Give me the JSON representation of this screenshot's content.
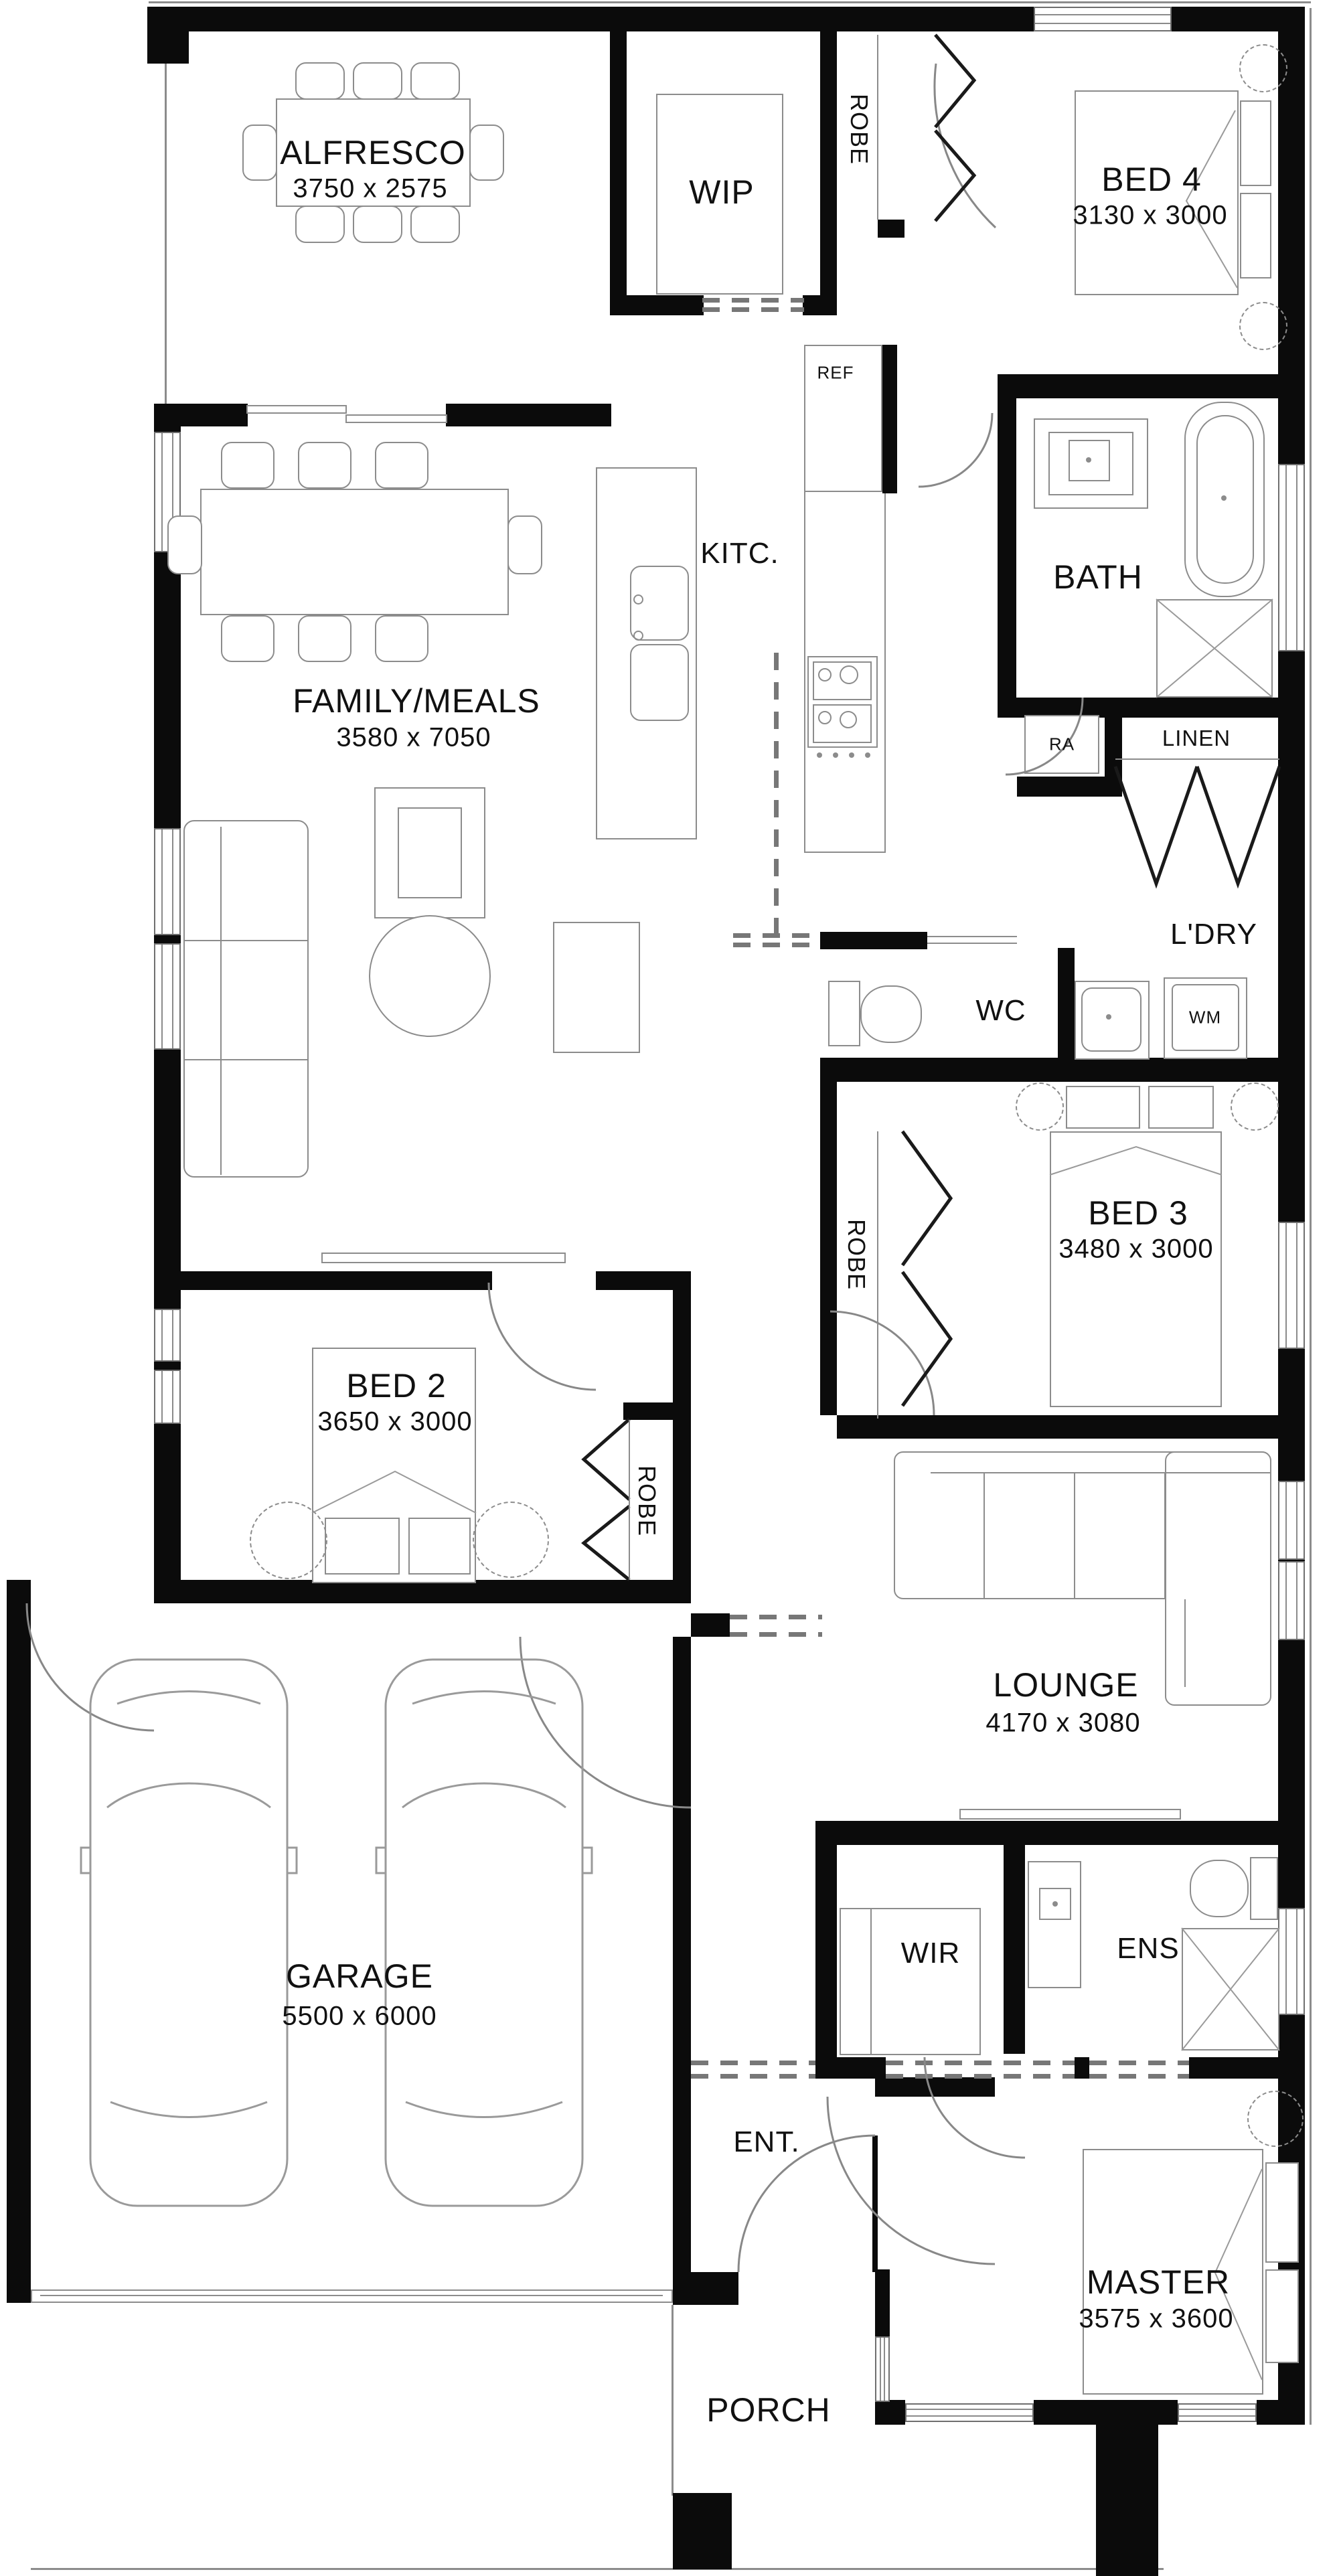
{
  "plan": {
    "background": "#ffffff",
    "wall_color": "#0b0b0b",
    "furniture_line_color": "#8c8c8c",
    "text_color": "#111111"
  },
  "rooms": {
    "alfresco": {
      "label": "ALFRESCO",
      "dims": "3750 x 2575"
    },
    "wip": {
      "label": "WIP"
    },
    "robe_bed4": {
      "label": "ROBE"
    },
    "bed4": {
      "label": "BED 4",
      "dims": "3130 x 3000"
    },
    "fridge": {
      "label": "REF"
    },
    "kitchen": {
      "label": "KITC."
    },
    "bath": {
      "label": "BATH"
    },
    "family": {
      "label": "FAMILY/MEALS",
      "dims": "3580 x 7050"
    },
    "return_air": {
      "label": "RA"
    },
    "linen": {
      "label": "LINEN"
    },
    "laundry": {
      "label": "L'DRY"
    },
    "wc": {
      "label": "WC"
    },
    "washing_machine": {
      "label": "WM"
    },
    "bed3": {
      "label": "BED 3",
      "dims": "3480 x 3000"
    },
    "robe_bed3": {
      "label": "ROBE"
    },
    "bed2": {
      "label": "BED 2",
      "dims": "3650 x 3000"
    },
    "robe_bed2": {
      "label": "ROBE"
    },
    "lounge": {
      "label": "LOUNGE",
      "dims": "4170 x 3080"
    },
    "garage": {
      "label": "GARAGE",
      "dims": "5500 x 6000"
    },
    "wir": {
      "label": "WIR"
    },
    "ens": {
      "label": "ENS"
    },
    "entry": {
      "label": "ENT."
    },
    "master": {
      "label": "MASTER",
      "dims": "3575 x 3600"
    },
    "porch": {
      "label": "PORCH"
    }
  }
}
